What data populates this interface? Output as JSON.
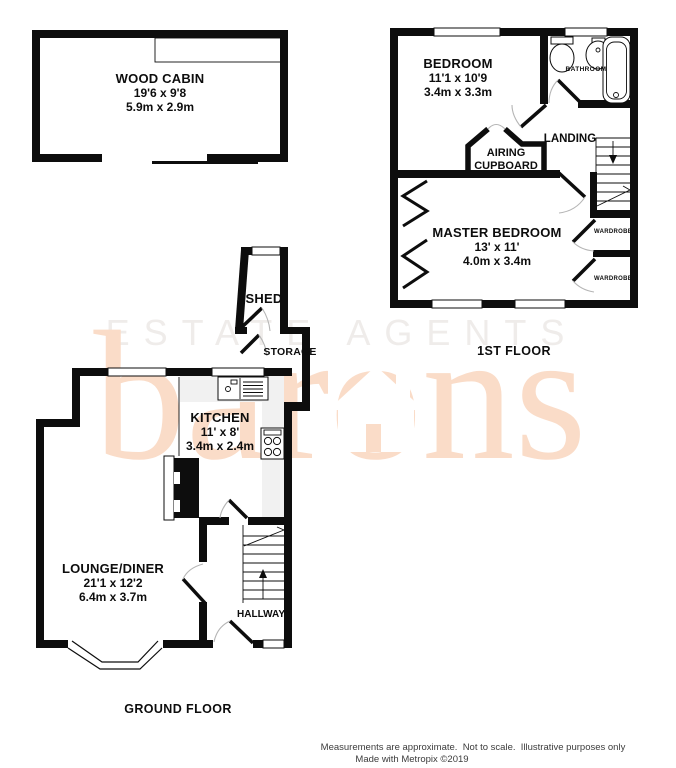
{
  "watermark": {
    "line1": "ESTATE AGENTS",
    "brand": "barons",
    "brand_color": "#fadcc8",
    "light_color": "#efecea"
  },
  "floors": {
    "first": "1ST FLOOR",
    "ground": "GROUND FLOOR"
  },
  "rooms": {
    "wood_cabin": {
      "name": "WOOD CABIN",
      "imperial": "19'6 x 9'8",
      "metric": "5.9m x 2.9m"
    },
    "bedroom": {
      "name": "BEDROOM",
      "imperial": "11'1 x 10'9",
      "metric": "3.4m x 3.3m"
    },
    "bathroom": {
      "name": "BATHROOM"
    },
    "landing": {
      "name": "LANDING"
    },
    "airing_cupboard": {
      "line1": "AIRING",
      "line2": "CUPBOARD"
    },
    "master_bedroom": {
      "name": "MASTER BEDROOM",
      "imperial": "13' x 11'",
      "metric": "4.0m x 3.4m"
    },
    "wardrobe1": {
      "name": "WARDROBE"
    },
    "wardrobe2": {
      "name": "WARDROBE"
    },
    "shed": {
      "name": "SHED"
    },
    "storage": {
      "name": "STORAGE"
    },
    "kitchen": {
      "name": "KITCHEN",
      "imperial": "11' x 8'",
      "metric": "3.4m x 2.4m"
    },
    "lounge": {
      "name": "LOUNGE/DINER",
      "imperial": "21'1 x 12'2",
      "metric": "6.4m x 3.7m"
    },
    "hallway": {
      "name": "HALLWAY"
    }
  },
  "footer": {
    "line1": "Measurements are approximate.  Not to scale.  Illustrative purposes only",
    "line2": "Made with Metropix ©2019"
  }
}
